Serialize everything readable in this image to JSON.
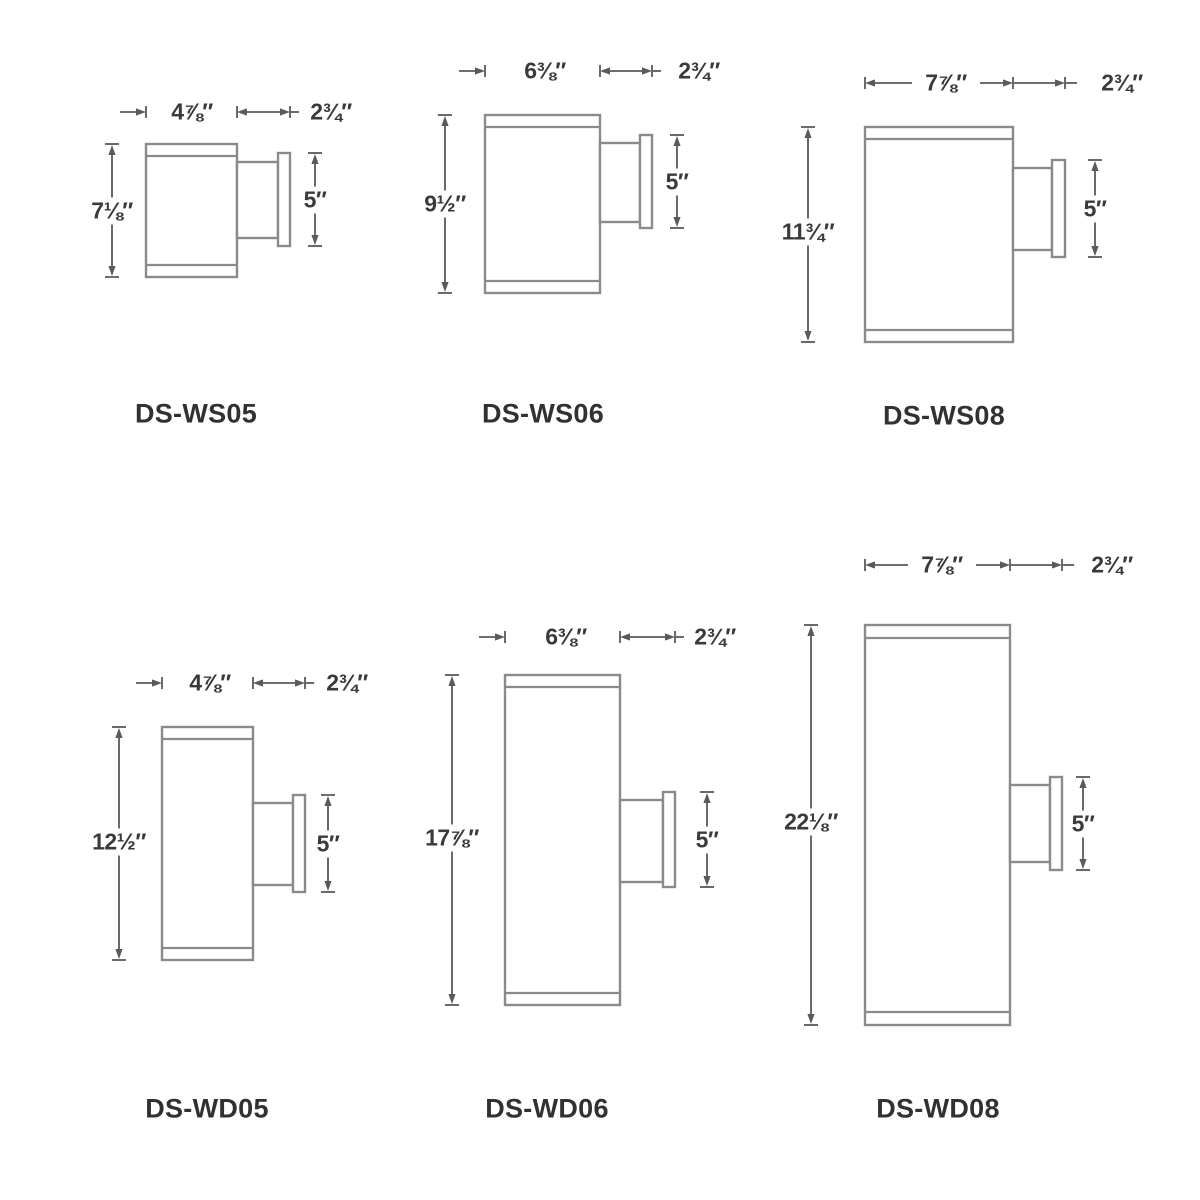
{
  "sheet": {
    "kind": "wall-sconce dimension spec drawings",
    "rows": 2,
    "columns": 3
  },
  "colors": {
    "background": "#ffffff",
    "drawing_line": "#8a8a8a",
    "dimension_line": "#5a5a5a",
    "dimension_text": "#3a3a3a",
    "model_text": "#313131"
  },
  "fixtures": [
    {
      "model": "DS-WS05",
      "width": "4⅞″",
      "mount_depth": "2¾″",
      "height": "7⅛″",
      "backplate_height": "5″"
    },
    {
      "model": "DS-WS06",
      "width": "6⅜″",
      "mount_depth": "2¾″",
      "height": "9½″",
      "backplate_height": "5″"
    },
    {
      "model": "DS-WS08",
      "width": "7⅞″",
      "mount_depth": "2¾″",
      "height": "11¾″",
      "backplate_height": "5″"
    },
    {
      "model": "DS-WD05",
      "width": "4⅞″",
      "mount_depth": "2¾″",
      "height": "12½″",
      "backplate_height": "5″"
    },
    {
      "model": "DS-WD06",
      "width": "6⅜″",
      "mount_depth": "2¾″",
      "height": "17⅞″",
      "backplate_height": "5″"
    },
    {
      "model": "DS-WD08",
      "width": "7⅞″",
      "mount_depth": "2¾″",
      "height": "22⅛″",
      "backplate_height": "5″"
    }
  ]
}
